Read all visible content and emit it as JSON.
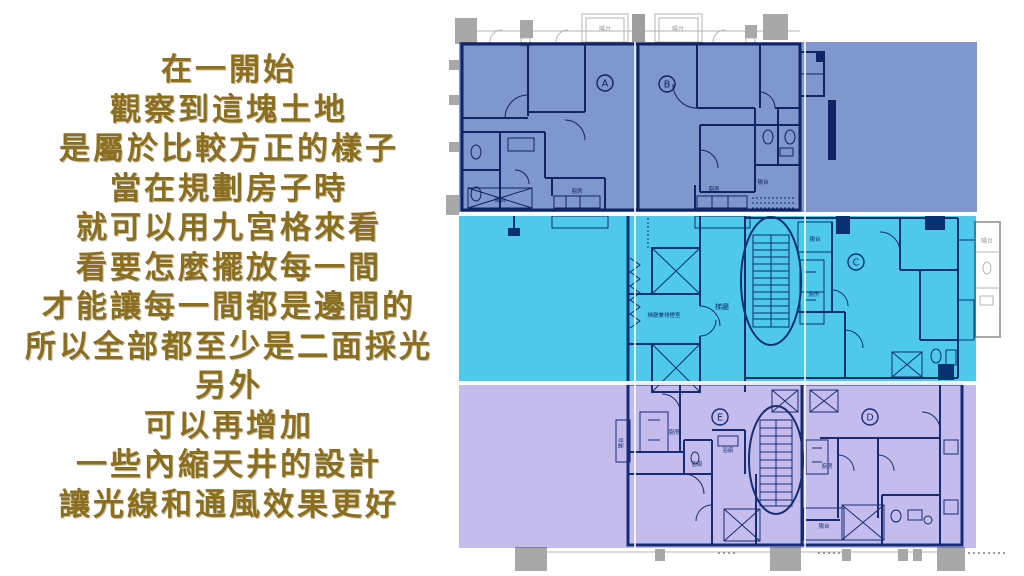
{
  "caption": {
    "lines": [
      "在一開始",
      "觀察到這塊土地",
      "是屬於比較方正的樣子",
      "當在規劃房子時",
      "就可以用九宮格來看",
      "看要怎麼擺放每一間",
      "才能讓每一間都是邊間的",
      "所以全部都至少是二面採光",
      "另外",
      "可以再增加",
      "一些內縮天井的設計",
      "讓光線和通風效果更好"
    ]
  },
  "plan": {
    "units": [
      "A",
      "B",
      "C",
      "D",
      "E"
    ],
    "labels": [
      "陽台",
      "陽台",
      "陽台",
      "廚房",
      "廚房",
      "陽台",
      "梯廳兼排煙室",
      "梯廳",
      "陽台",
      "廚房",
      "廚房",
      "浴廁",
      "浴廁",
      "廚房",
      "陽台",
      "陽台",
      "陽台"
    ]
  },
  "colors": {
    "caption_text": "#8b6f1e",
    "band_top": "#7E97CD",
    "band_middle": "#4FC9E9",
    "band_bottom": "#C3BCEC",
    "plan_line": "#1d3c7c",
    "plan_gray": "#a8a8a8"
  }
}
